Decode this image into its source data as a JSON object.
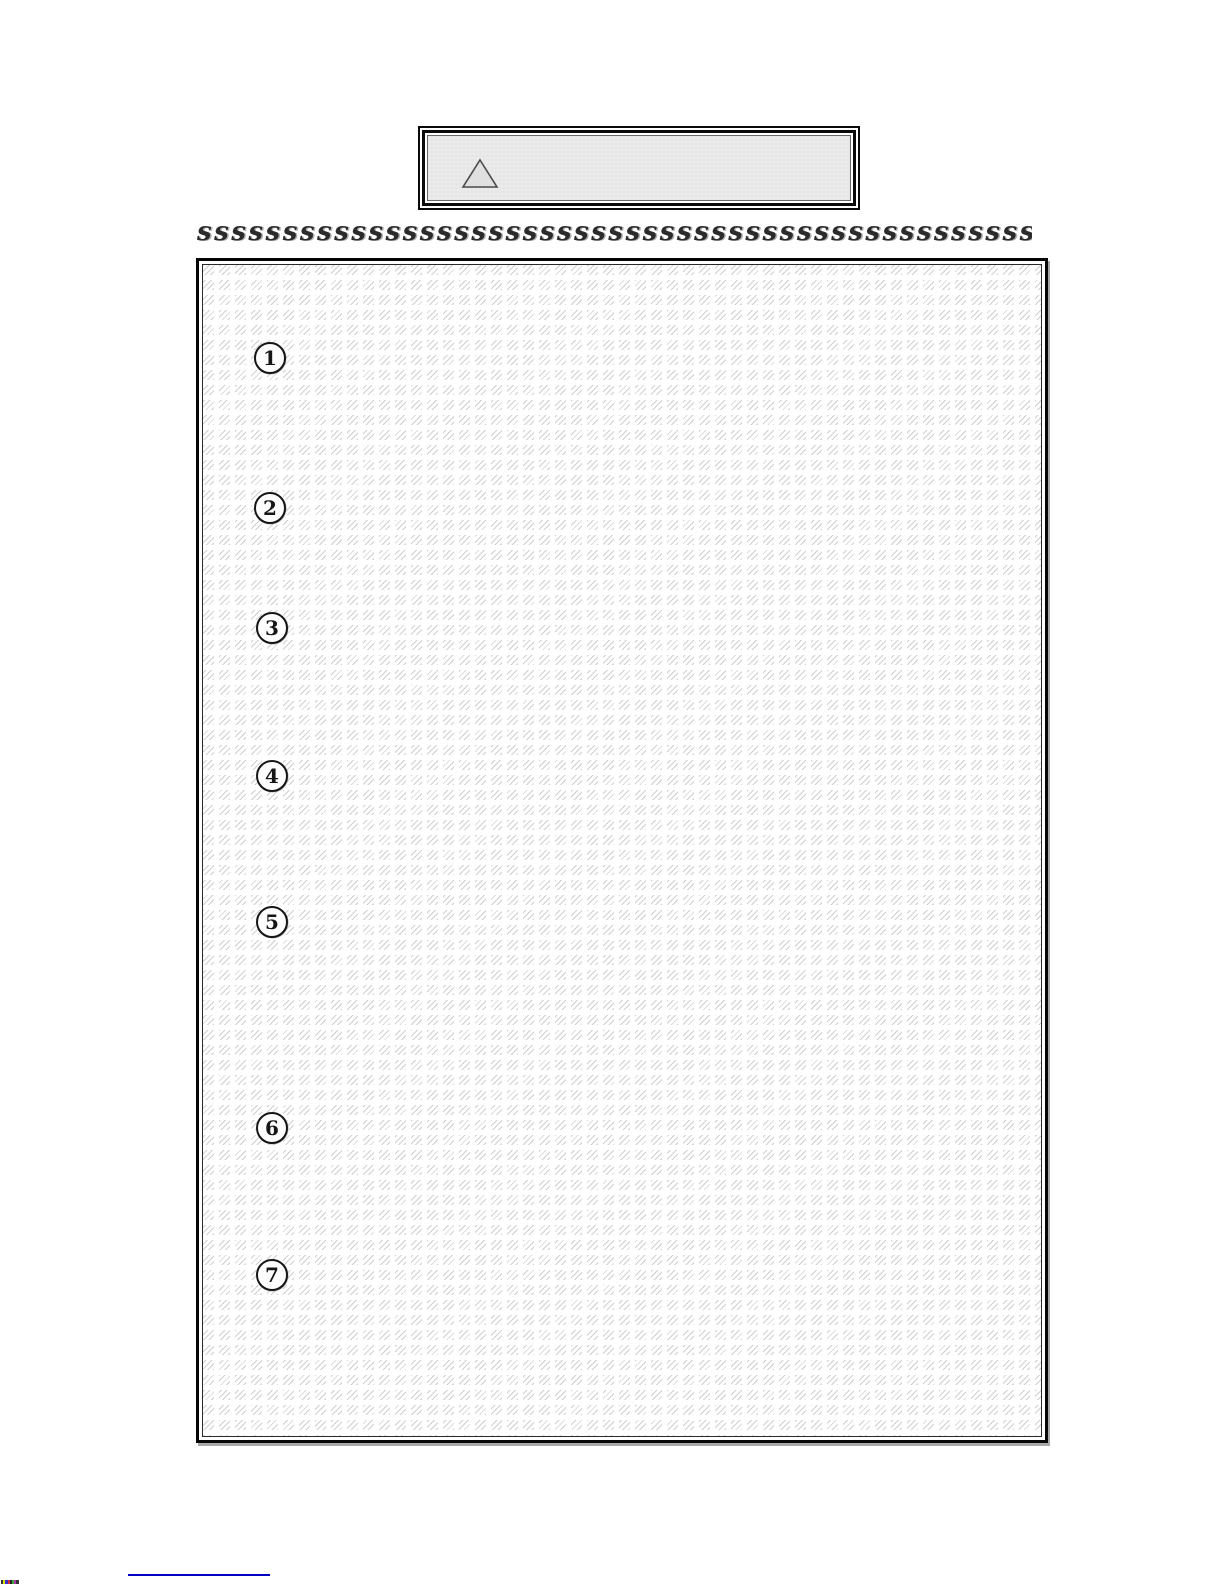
{
  "header": {
    "warning_box": {
      "icon": "warning-triangle-icon",
      "fill_color": "#e7e7e7",
      "border_color": "#0a0a0a"
    }
  },
  "divider": {
    "text": "ssssssssssssssssssssssssssssssssssssssssssssssssssssssssssss"
  },
  "content_box": {
    "fill": "hatched-redacted-lines",
    "hatch_color": "#cfcfcf",
    "list_items": [
      {
        "number": "1"
      },
      {
        "number": "2"
      },
      {
        "number": "3"
      },
      {
        "number": "4"
      },
      {
        "number": "5"
      },
      {
        "number": "6"
      },
      {
        "number": "7"
      }
    ]
  },
  "footer": {
    "link_underline_color": "#0000c4"
  },
  "scan_artifact": {
    "colors": [
      "#333333",
      "#dddd00",
      "#3333cc",
      "#cc3333",
      "#222222",
      "#33aa33",
      "#aa33aa",
      "#333333"
    ]
  },
  "colors": {
    "page_bg": "#ffffff",
    "border_black": "#0a0a0a",
    "hatch_line": "#cfcfcf",
    "warn_fill": "#e7e7e7",
    "link_blue": "#0000c4"
  }
}
